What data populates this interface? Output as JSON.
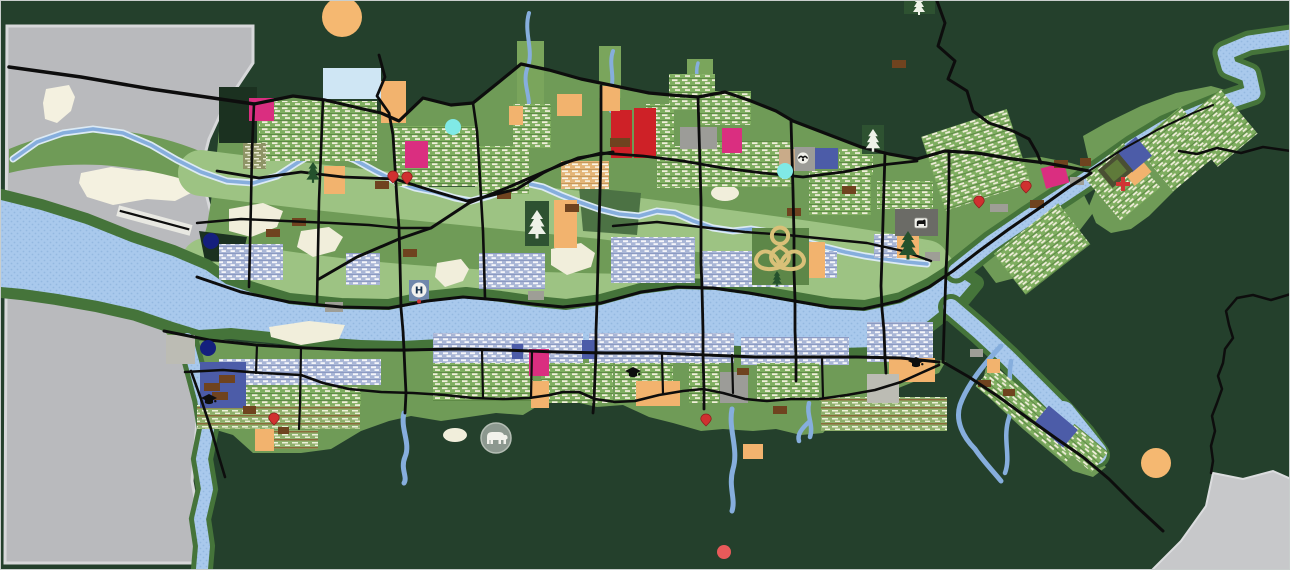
{
  "map": {
    "type": "urban-master-plan-map",
    "labels": {
      "helipad": "H"
    },
    "palette": {
      "forest": "#24402c",
      "forestDark": "#1b3120",
      "mountain": "#b9babd",
      "mountainEdge": "#d7d8da",
      "snow": "#f4f1e0",
      "riverFill": "#a9c9ec",
      "stream": "#86aedd",
      "bankGreen": "#45743a",
      "bankDark": "#1f3a1c",
      "urban": "#6f9b57",
      "field": "#9dc383",
      "parkCream": "#f1eedb",
      "road": "#0d0d0d",
      "magenta": "#da2e80",
      "red": "#ce2127",
      "orange": "#f2b36e",
      "lightBlue": "#cfe6f4",
      "indigo": "#4c5ca8",
      "navy": "#141f7d",
      "cyan": "#80e9e6",
      "orangeDot": "#f5b871",
      "redDot": "#e85a5a",
      "pinRed": "#d03030",
      "brown": "#6f431f",
      "dock": "#9e9e96",
      "grayBlock": "#9c9c98",
      "darkGray": "#6b6b66",
      "brick": "#bcbcb4",
      "olive": "#8e9466",
      "tanBlock": "#c9ab89",
      "gold": "#d9c078",
      "padBlue": "#7088ac",
      "templeDark": "#4a4f33",
      "templeGreen": "#5f7a3a",
      "lotusGreen": "#5d8748",
      "pineDark": "#2e5231"
    },
    "zones": [
      {
        "name": "light-blue-block",
        "color": "lightBlue",
        "x": 322,
        "y": 67,
        "w": 58,
        "h": 31
      },
      {
        "name": "magenta-block-1",
        "color": "magenta",
        "x": 248,
        "y": 97,
        "w": 25,
        "h": 23
      },
      {
        "name": "magenta-block-2",
        "color": "magenta",
        "x": 404,
        "y": 140,
        "w": 23,
        "h": 27
      },
      {
        "name": "magenta-block-3",
        "color": "magenta",
        "x": 721,
        "y": 127,
        "w": 20,
        "h": 25
      },
      {
        "name": "magenta-block-4",
        "color": "magenta",
        "x": 1042,
        "y": 164,
        "w": 24,
        "h": 21,
        "rot": -15
      },
      {
        "name": "magenta-block-5",
        "color": "magenta",
        "x": 528,
        "y": 348,
        "w": 20,
        "h": 27
      },
      {
        "name": "red-center-block-1",
        "color": "red",
        "x": 610,
        "y": 109,
        "w": 21,
        "h": 48
      },
      {
        "name": "red-center-block-2",
        "color": "red",
        "x": 633,
        "y": 107,
        "w": 22,
        "h": 50
      },
      {
        "name": "orange-block-1",
        "color": "orange",
        "x": 380,
        "y": 80,
        "w": 25,
        "h": 42
      },
      {
        "name": "orange-block-2",
        "color": "orange",
        "x": 508,
        "y": 105,
        "w": 14,
        "h": 19
      },
      {
        "name": "orange-block-3",
        "color": "orange",
        "x": 556,
        "y": 93,
        "w": 25,
        "h": 22
      },
      {
        "name": "orange-block-4",
        "color": "orange",
        "x": 599,
        "y": 85,
        "w": 20,
        "h": 25
      },
      {
        "name": "orange-block-5",
        "color": "orange",
        "x": 323,
        "y": 165,
        "w": 21,
        "h": 28
      },
      {
        "name": "orange-block-6",
        "color": "orange",
        "x": 553,
        "y": 199,
        "w": 23,
        "h": 48
      },
      {
        "name": "orange-block-7",
        "color": "orange",
        "x": 803,
        "y": 241,
        "w": 21,
        "h": 36
      },
      {
        "name": "orange-block-8",
        "color": "orange",
        "x": 896,
        "y": 230,
        "w": 22,
        "h": 27
      },
      {
        "name": "orange-block-9",
        "color": "orange",
        "x": 1125,
        "y": 161,
        "w": 22,
        "h": 19,
        "rot": -40
      },
      {
        "name": "orange-block-10",
        "color": "orange",
        "x": 635,
        "y": 380,
        "w": 44,
        "h": 25
      },
      {
        "name": "orange-block-11",
        "color": "orange",
        "x": 530,
        "y": 380,
        "w": 18,
        "h": 27
      },
      {
        "name": "orange-block-12",
        "color": "orange",
        "x": 254,
        "y": 428,
        "w": 19,
        "h": 22
      },
      {
        "name": "orange-block-13",
        "color": "orange",
        "x": 742,
        "y": 443,
        "w": 20,
        "h": 15
      },
      {
        "name": "orange-block-14",
        "color": "orange",
        "x": 888,
        "y": 357,
        "w": 46,
        "h": 24
      },
      {
        "name": "orange-block-15",
        "color": "orange",
        "x": 986,
        "y": 358,
        "w": 13,
        "h": 14
      },
      {
        "name": "indigo-block-1",
        "color": "indigo",
        "x": 813,
        "y": 147,
        "w": 24,
        "h": 21
      },
      {
        "name": "indigo-block-2",
        "color": "indigo",
        "x": 1120,
        "y": 141,
        "w": 26,
        "h": 25,
        "rot": -40
      },
      {
        "name": "indigo-block-3",
        "color": "indigo",
        "x": 199,
        "y": 361,
        "w": 46,
        "h": 46
      },
      {
        "name": "indigo-block-4",
        "color": "indigo",
        "x": 581,
        "y": 339,
        "w": 13,
        "h": 19
      },
      {
        "name": "indigo-block-5",
        "color": "indigo",
        "x": 511,
        "y": 343,
        "w": 11,
        "h": 15
      },
      {
        "name": "indigo-block-6",
        "color": "indigo",
        "x": 1036,
        "y": 414,
        "w": 38,
        "h": 23,
        "rot": 40
      },
      {
        "name": "gray-hatch-block-1",
        "color": "grayBlock",
        "x": 679,
        "y": 126,
        "w": 37,
        "h": 22
      },
      {
        "name": "gray-hatch-block-2",
        "color": "grayBlock",
        "x": 793,
        "y": 146,
        "w": 21,
        "h": 24
      },
      {
        "name": "dark-gray-block",
        "color": "darkGray",
        "x": 894,
        "y": 208,
        "w": 43,
        "h": 27
      },
      {
        "name": "gray-hatch-block-3",
        "color": "grayBlock",
        "x": 719,
        "y": 371,
        "w": 28,
        "h": 31
      },
      {
        "name": "brick-block-1",
        "color": "brick",
        "x": 165,
        "y": 334,
        "w": 29,
        "h": 29
      },
      {
        "name": "brick-block-2",
        "color": "brick",
        "x": 866,
        "y": 373,
        "w": 32,
        "h": 29
      },
      {
        "name": "tan-block",
        "color": "tanBlock",
        "x": 778,
        "y": 148,
        "w": 16,
        "h": 22
      },
      {
        "name": "temple-frame",
        "color": "templeDark",
        "x": 1101,
        "y": 158,
        "w": 27,
        "h": 23,
        "rot": -40
      },
      {
        "name": "temple-court",
        "color": "templeGreen",
        "x": 1106,
        "y": 162,
        "w": 17,
        "h": 15,
        "rot": -40
      },
      {
        "name": "pine-block-1",
        "color": "pineDark",
        "x": 524,
        "y": 200,
        "w": 24,
        "h": 45
      },
      {
        "name": "pine-block-2",
        "color": "pineDark",
        "x": 861,
        "y": 124,
        "w": 22,
        "h": 29
      },
      {
        "name": "pine-block-3",
        "color": "pineDark",
        "x": 903,
        "y": 0,
        "w": 31,
        "h": 13
      },
      {
        "name": "lotus-block",
        "color": "lotusGreen",
        "x": 751,
        "y": 227,
        "w": 57,
        "h": 57
      },
      {
        "name": "helipad-pad",
        "color": "padBlue",
        "x": 408,
        "y": 279,
        "w": 20,
        "h": 21
      }
    ],
    "small_rects": [
      {
        "name": "brown-lot-1",
        "color": "brown",
        "x": 291,
        "y": 217
      },
      {
        "name": "brown-lot-2",
        "color": "brown",
        "x": 265,
        "y": 228
      },
      {
        "name": "brown-lot-3",
        "color": "brown",
        "x": 374,
        "y": 180
      },
      {
        "name": "brown-lot-4",
        "color": "brown",
        "x": 402,
        "y": 248
      },
      {
        "name": "brown-lot-5",
        "color": "brown",
        "x": 496,
        "y": 190
      },
      {
        "name": "brown-lot-6",
        "color": "brown",
        "x": 564,
        "y": 203
      },
      {
        "name": "brown-lot-7",
        "color": "brown",
        "x": 786,
        "y": 207
      },
      {
        "name": "brown-lot-8",
        "color": "brown",
        "x": 841,
        "y": 185
      },
      {
        "name": "brown-lot-9",
        "color": "brown",
        "x": 891,
        "y": 59
      },
      {
        "name": "brown-lot-10",
        "color": "brown",
        "x": 1053,
        "y": 159
      },
      {
        "name": "brown-lot-11",
        "color": "brown",
        "x": 1029,
        "y": 199
      },
      {
        "name": "brown-lot-12",
        "color": "brown",
        "x": 1079,
        "y": 157,
        "w": 11,
        "h": 8
      },
      {
        "name": "brown-lot-13",
        "color": "brown",
        "x": 736,
        "y": 367,
        "w": 12,
        "h": 7
      },
      {
        "name": "brown-lot-14",
        "color": "brown",
        "x": 772,
        "y": 405
      },
      {
        "name": "brown-lot-15",
        "color": "brown",
        "x": 242,
        "y": 405,
        "w": 13,
        "h": 8
      },
      {
        "name": "brown-lot-16",
        "color": "brown",
        "x": 277,
        "y": 426,
        "w": 11,
        "h": 7
      },
      {
        "name": "brown-step-1",
        "color": "brown",
        "x": 218,
        "y": 374,
        "w": 16,
        "h": 8
      },
      {
        "name": "brown-step-2",
        "color": "brown",
        "x": 203,
        "y": 382,
        "w": 16,
        "h": 8
      },
      {
        "name": "brown-step-3",
        "color": "brown",
        "x": 211,
        "y": 391,
        "w": 16,
        "h": 8
      },
      {
        "name": "brown-lot-17",
        "color": "brown",
        "x": 609,
        "y": 137,
        "w": 20,
        "h": 9
      },
      {
        "name": "brown-lot-18",
        "color": "brown",
        "x": 977,
        "y": 379,
        "w": 13,
        "h": 7
      },
      {
        "name": "brown-lot-19",
        "color": "brown",
        "x": 1002,
        "y": 388,
        "w": 12,
        "h": 7
      },
      {
        "name": "dock-1",
        "color": "dock",
        "x": 324,
        "y": 301,
        "w": 18,
        "h": 10
      },
      {
        "name": "dock-2",
        "color": "dock",
        "x": 527,
        "y": 290,
        "w": 16,
        "h": 9
      },
      {
        "name": "dock-3",
        "color": "dock",
        "x": 989,
        "y": 203,
        "w": 18,
        "h": 8
      },
      {
        "name": "dock-4",
        "color": "dock",
        "x": 1069,
        "y": 176,
        "w": 14,
        "h": 8
      },
      {
        "name": "dock-5",
        "color": "dock",
        "x": 924,
        "y": 251,
        "w": 15,
        "h": 9
      },
      {
        "name": "dock-6",
        "color": "dock",
        "x": 969,
        "y": 348,
        "w": 13,
        "h": 8
      }
    ],
    "circles": [
      {
        "name": "navy-marker-1",
        "color": "navy",
        "x": 210,
        "y": 240,
        "r": 8
      },
      {
        "name": "navy-marker-2",
        "color": "navy",
        "x": 207,
        "y": 347,
        "r": 8
      },
      {
        "name": "cyan-marker-1",
        "color": "cyan",
        "x": 452,
        "y": 126,
        "r": 8
      },
      {
        "name": "cyan-marker-2",
        "color": "cyan",
        "x": 784,
        "y": 170,
        "r": 8
      },
      {
        "name": "orange-marker-1",
        "color": "orangeDot",
        "x": 341,
        "y": 16,
        "r": 20
      },
      {
        "name": "orange-marker-2",
        "color": "orangeDot",
        "x": 1155,
        "y": 462,
        "r": 15
      },
      {
        "name": "red-marker",
        "color": "redDot",
        "x": 723,
        "y": 551,
        "r": 7
      }
    ],
    "pins": [
      {
        "name": "poi-pin-1",
        "x": 392,
        "y": 176
      },
      {
        "name": "poi-pin-2",
        "x": 406,
        "y": 177
      },
      {
        "name": "poi-pin-3",
        "x": 273,
        "y": 418
      },
      {
        "name": "poi-pin-4",
        "x": 705,
        "y": 419
      },
      {
        "name": "poi-pin-5",
        "x": 978,
        "y": 201
      },
      {
        "name": "poi-pin-6",
        "x": 1025,
        "y": 186
      }
    ],
    "icons": [
      {
        "name": "pine-tree-1",
        "type": "pine",
        "x": 312,
        "y": 172,
        "variant": "dark",
        "scale": 1.1
      },
      {
        "name": "pine-tree-2",
        "type": "pine",
        "x": 536,
        "y": 224,
        "variant": "light",
        "scale": 1.5
      },
      {
        "name": "pine-tree-3",
        "type": "pine",
        "x": 872,
        "y": 140,
        "variant": "light",
        "scale": 1.2
      },
      {
        "name": "pine-tree-4",
        "type": "pine",
        "x": 918,
        "y": 5,
        "variant": "light",
        "scale": 1
      },
      {
        "name": "pine-tree-5",
        "type": "pine",
        "x": 907,
        "y": 245,
        "variant": "dark",
        "scale": 1.5
      },
      {
        "name": "pine-tree-6",
        "type": "pine",
        "x": 776,
        "y": 278,
        "variant": "dark",
        "scale": 0.8
      },
      {
        "name": "graduation-cap-icon-1",
        "type": "cap",
        "x": 208,
        "y": 399,
        "scale": 1
      },
      {
        "name": "graduation-cap-icon-2",
        "type": "cap",
        "x": 632,
        "y": 372,
        "scale": 1
      },
      {
        "name": "graduation-cap-icon-3",
        "type": "cap",
        "x": 915,
        "y": 362,
        "scale": 1
      },
      {
        "name": "medical-cross-icon",
        "type": "cross",
        "x": 1122,
        "y": 183,
        "scale": 1
      },
      {
        "name": "bird-icon",
        "type": "bird",
        "x": 802,
        "y": 157,
        "scale": 1
      },
      {
        "name": "animal-icon",
        "type": "animal",
        "x": 920,
        "y": 222,
        "scale": 1
      },
      {
        "name": "elephant-icon",
        "type": "elephant",
        "x": 495,
        "y": 437,
        "scale": 1
      },
      {
        "name": "lotus-icon",
        "type": "lotus",
        "x": 779,
        "y": 256,
        "scale": 1.25
      }
    ]
  }
}
